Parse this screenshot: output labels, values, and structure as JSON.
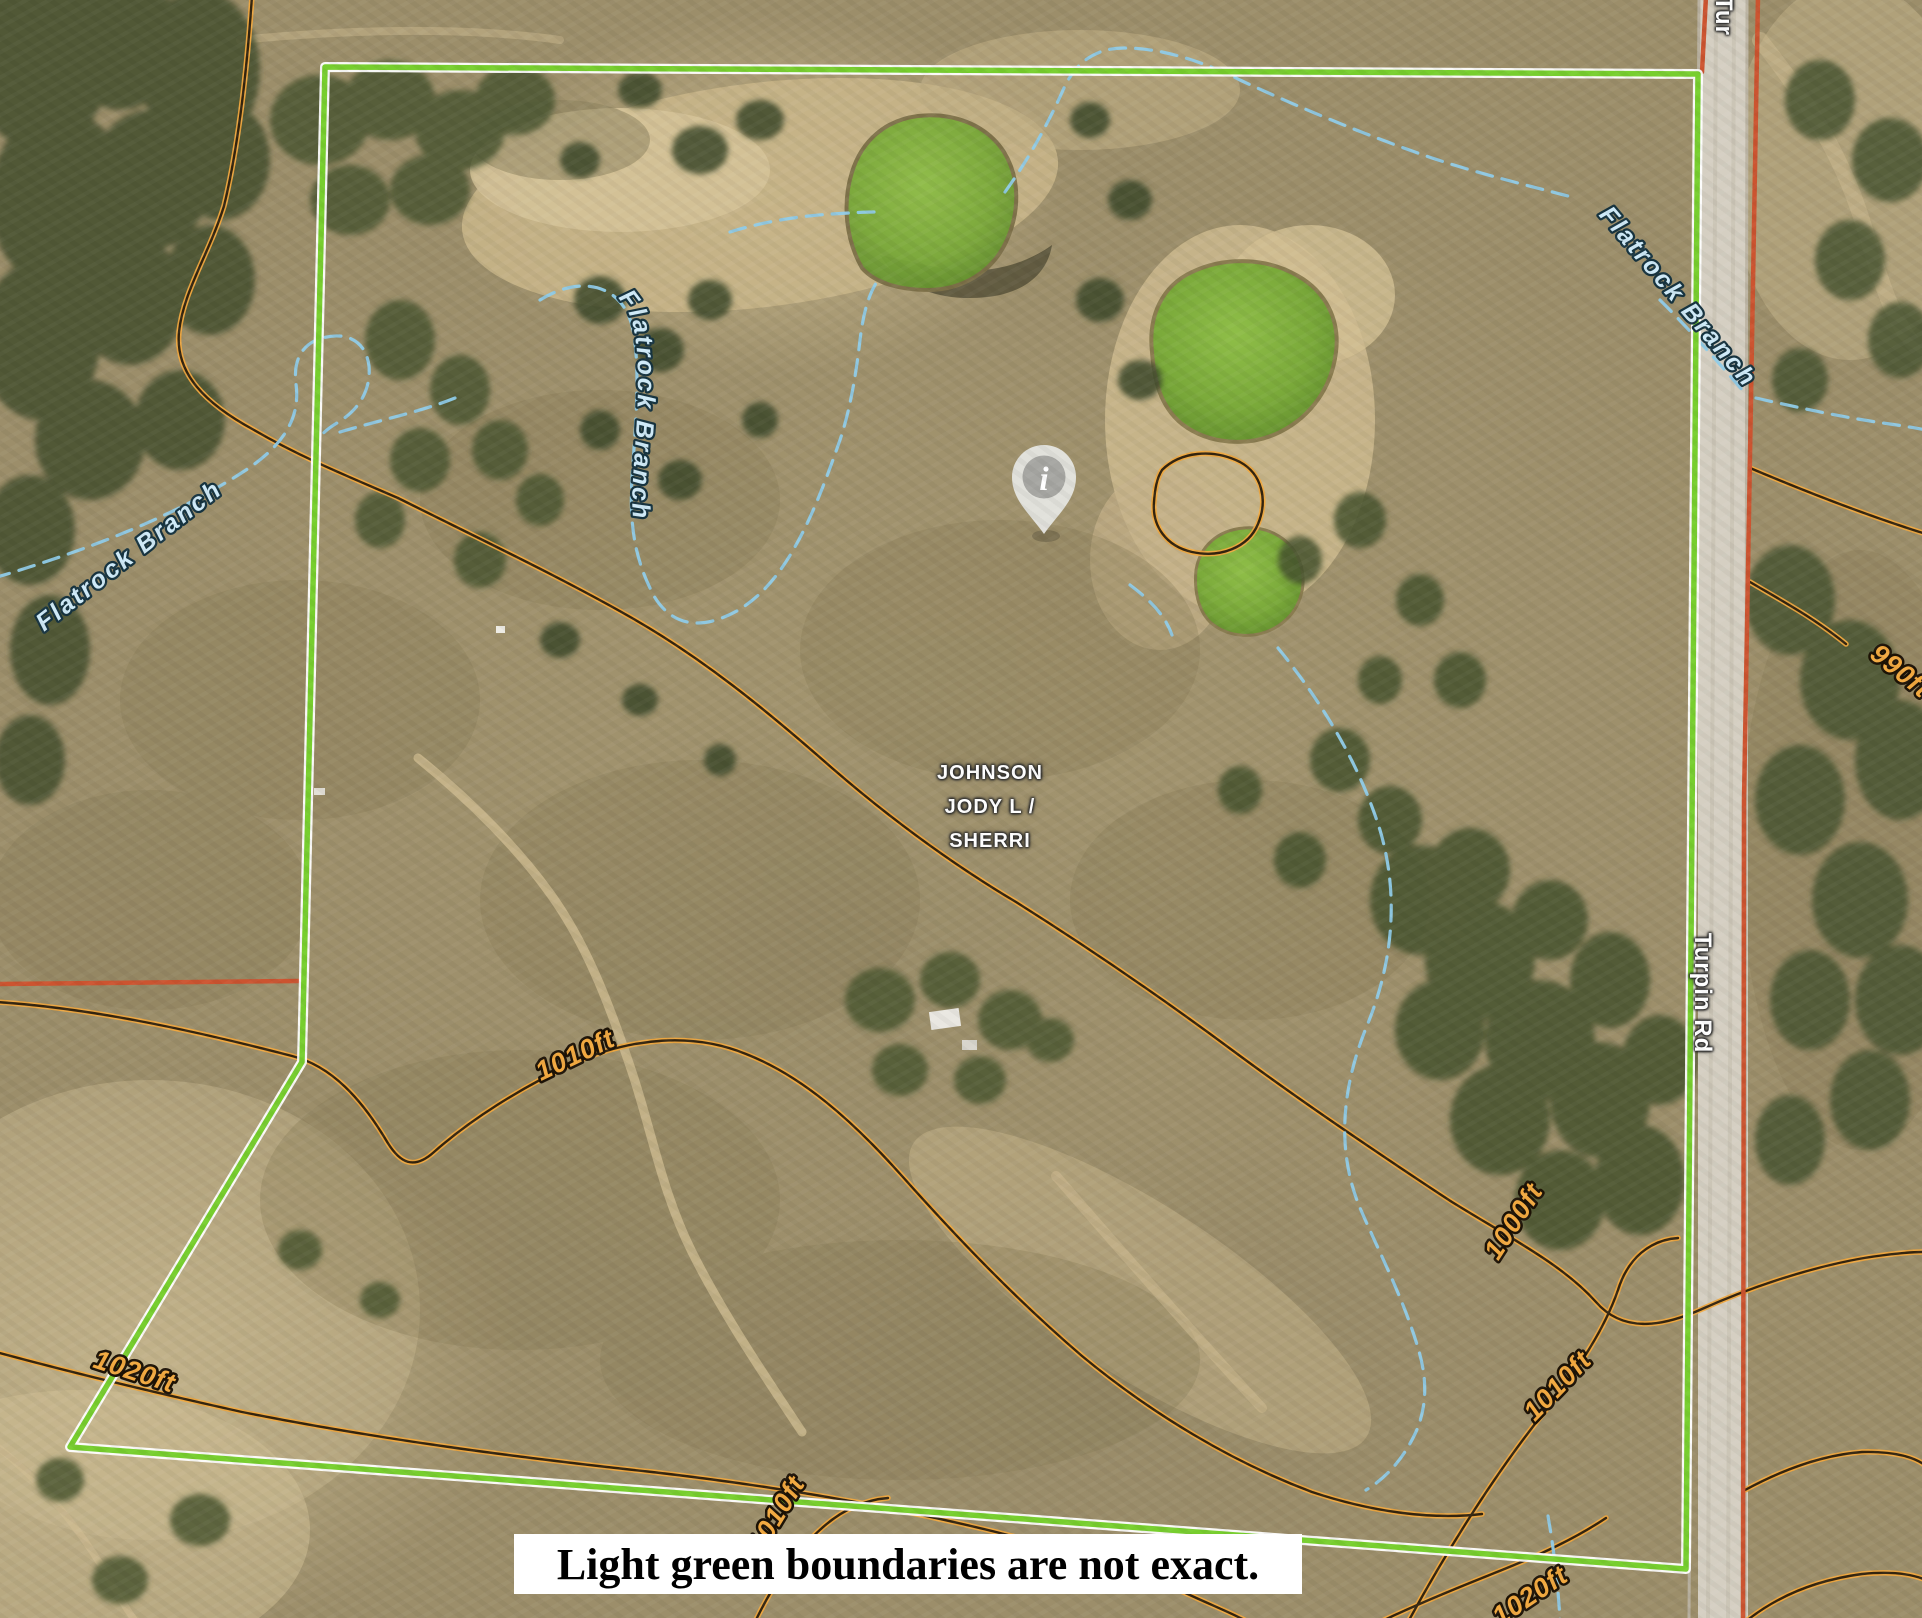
{
  "parcel": {
    "owner_line1": "JOHNSON",
    "owner_line2": "JODY L /",
    "owner_line3": "SHERRI"
  },
  "roads": {
    "main_label": "Turpin Rd",
    "top_label_partial": "Tur"
  },
  "streams": {
    "west_label": "Flatrock Branch",
    "mid_label": "Flatrock Branch",
    "northeast_label": "Flatrock Branch"
  },
  "contour_labels": {
    "c990": "990ft",
    "c1000": "1000ft",
    "c1010_west": "1010ft",
    "c1010_center": "1010ft",
    "c1010_east": "1010ft",
    "c1020_west": "1020ft",
    "c1020_southeast": "1020ft"
  },
  "marker": {
    "glyph": "i"
  },
  "caption": {
    "text": "Light green boundaries are not exact."
  },
  "colors": {
    "boundary_green": "#77CE2E",
    "boundary_casing": "#FFFFFF",
    "parcel_red": "#CC5430",
    "contour_halo": "#F2A93F",
    "contour_core": "#33240F",
    "stream_blue": "#8FCBE8",
    "stream_label_fill": "#CFEAF8",
    "contour_label_fill": "#F2A940",
    "road_fill": "#D5CFC2",
    "pond_green": "#82B33C",
    "caption_bg": "#FFFFFF",
    "caption_text": "#000000"
  }
}
